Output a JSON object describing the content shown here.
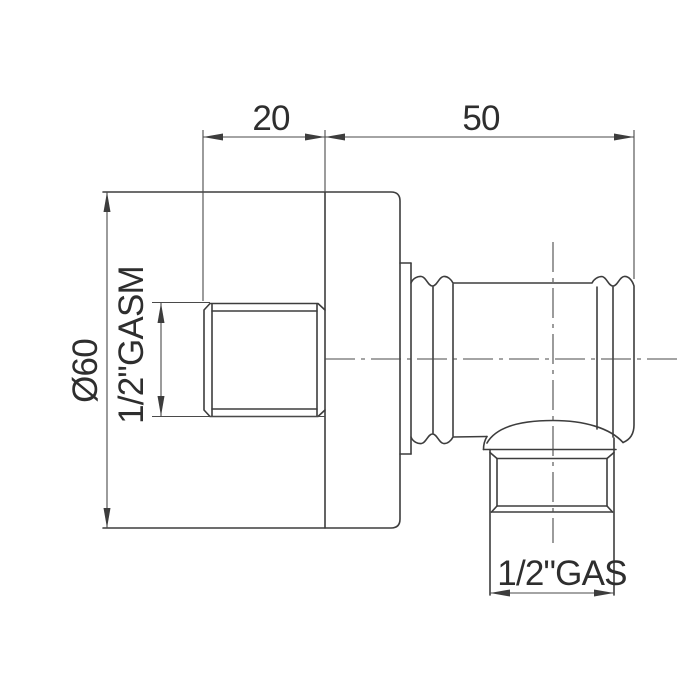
{
  "colors": {
    "background": "#ffffff",
    "line": "#3d3d3d",
    "thin_line": "#4a4a4a",
    "text": "#2e2e2e"
  },
  "drawing": {
    "view": "side-view-dimension-drawing",
    "dimensions": {
      "protrusion_length": {
        "value": "20"
      },
      "barrel_length": {
        "value": "50"
      },
      "flange_diameter": {
        "value": "Ø60"
      },
      "inlet_thread": {
        "value": "1/2\"GASM"
      },
      "outlet_thread": {
        "value": "1/2\"GAS"
      }
    }
  }
}
